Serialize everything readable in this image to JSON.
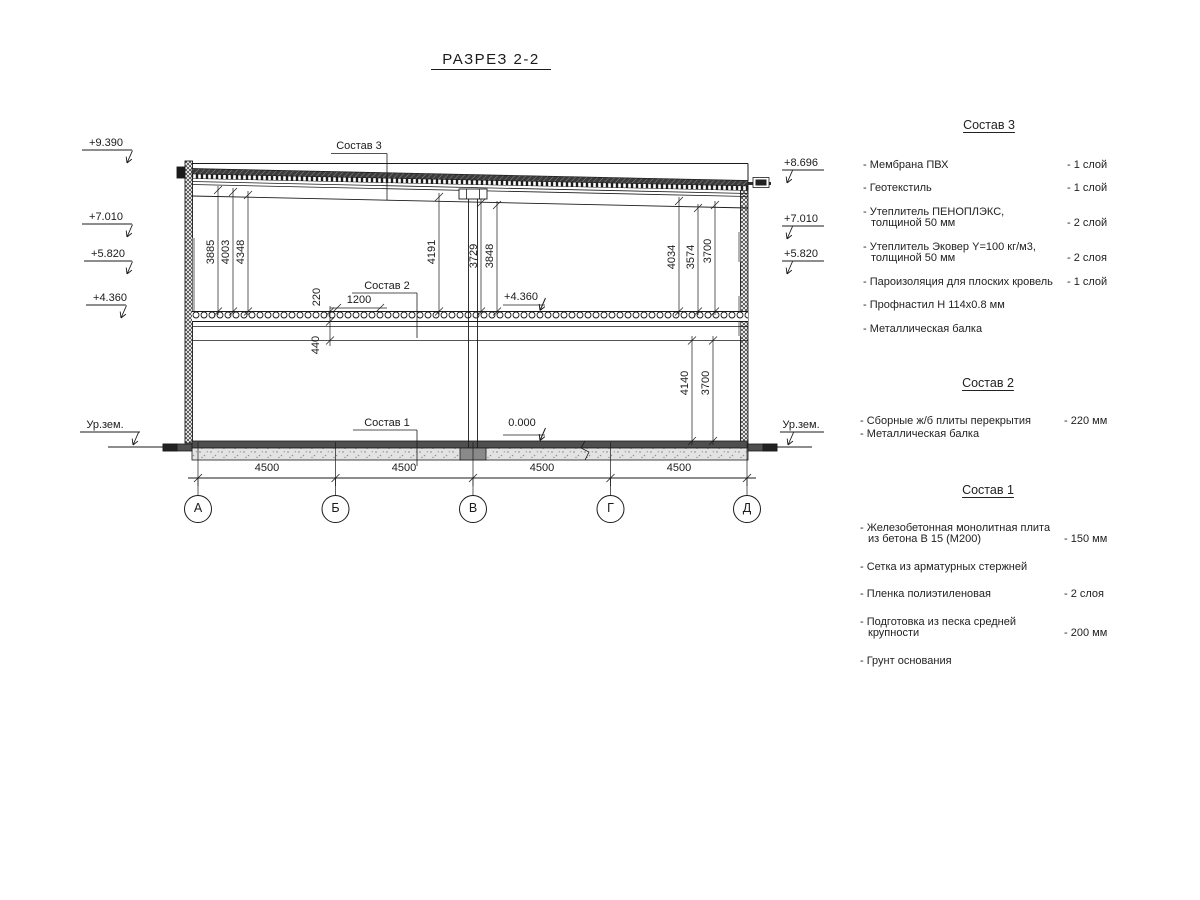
{
  "title": "РАЗРЕЗ 2-2",
  "drawing": {
    "marks_left": [
      "+9.390",
      "+7.010",
      "+5.820",
      "+4.360",
      "Ур.зем."
    ],
    "marks_right": [
      "+8.696",
      "+7.010",
      "+5.820",
      "Ур.зем."
    ],
    "levels": {
      "mid": "+4.360",
      "zero": "0.000"
    },
    "leaders": {
      "c3": "Состав 3",
      "c2": "Состав 2",
      "c1": "Состав 1"
    },
    "dims": {
      "upper_left": [
        "3885",
        "4003",
        "4348"
      ],
      "middle": [
        "4191",
        "3729",
        "3848"
      ],
      "upper_right": [
        "4034",
        "3574",
        "3700"
      ],
      "lower_right": [
        "4140",
        "3700"
      ],
      "slab_thickness": "220",
      "beam_depth": "440",
      "opening_width": "1200",
      "bay_widths": [
        "4500",
        "4500",
        "4500",
        "4500"
      ]
    },
    "axes": [
      "А",
      "Б",
      "В",
      "Г",
      "Д"
    ]
  },
  "legend": {
    "sections": [
      {
        "title": "Состав 3",
        "items": [
          {
            "name": "- Мембрана ПВХ",
            "qty": "- 1 слой"
          },
          {
            "name": "- Геотекстиль",
            "qty": "- 1 слой"
          },
          {
            "name": "- Утеплитель ПЕНОПЛЭКС,\nтолщиной 50 мм",
            "qty": "- 2 слой"
          },
          {
            "name": "- Утеплитель Эковер Y=100 кг/м3,\nтолщиной 50 мм",
            "qty": "- 2 слоя"
          },
          {
            "name": "- Пароизоляция для плоских кровель",
            "qty": "- 1 слой"
          },
          {
            "name": "- Профнастил Н 114х0.8 мм",
            "qty": ""
          },
          {
            "name": "- Металлическая балка",
            "qty": ""
          }
        ]
      },
      {
        "title": "Состав 2",
        "items": [
          {
            "name": "- Сборные ж/б плиты перекрытия",
            "qty": "- 220 мм"
          },
          {
            "name": "- Металлическая балка",
            "qty": ""
          }
        ]
      },
      {
        "title": "Состав 1",
        "items": [
          {
            "name": "- Железобетонная  монолитная плита\nиз бетона В 15 (М200)",
            "qty": "- 150 мм"
          },
          {
            "name": "- Сетка из арматурных стержней",
            "qty": ""
          },
          {
            "name": "- Пленка полиэтиленовая",
            "qty": "-  2 слоя"
          },
          {
            "name": "- Подготовка из песка средней\nкрупности",
            "qty": "- 200 мм"
          },
          {
            "name": "- Грунт основания",
            "qty": ""
          }
        ]
      }
    ]
  }
}
